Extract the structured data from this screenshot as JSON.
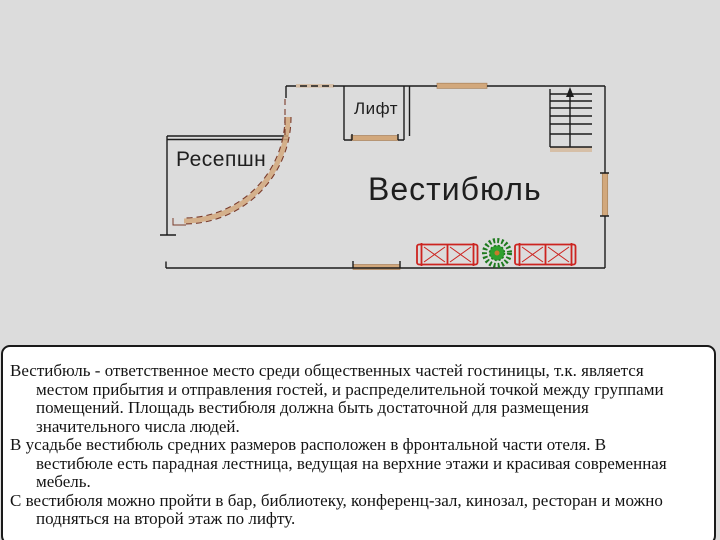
{
  "theme": {
    "slide_bg": "#dcdcdc",
    "wall": "#1c1c1c",
    "door": "#d2a87c",
    "door_edge": "#a8825c",
    "desk_edge": "#7a3b2a",
    "sofa": "#cc2420",
    "plant": "#2fa02f",
    "plant_dark": "#1e7a1e",
    "plant_center": "#c87a2a",
    "panel_bg": "#ffffff",
    "panel_border": "#1a1a1a",
    "text": "#141414"
  },
  "plan": {
    "labels": {
      "elevator": "Лифт",
      "reception": "Ресепшн",
      "lobby": "Вестибюль"
    },
    "furniture": [
      "sofa",
      "plant",
      "sofa",
      "reception-desk",
      "stairs"
    ]
  },
  "notes": {
    "paragraphs": [
      {
        "lines": [
          "Вестибюль - ответственное место среди общественных частей гостиницы, т.к. является",
          "местом прибытия и отправления гостей, и распределительной точкой между группами",
          "помещений. Площадь вестибюля должна быть достаточной для размещения",
          "значительного числа людей."
        ]
      },
      {
        "lines": [
          "В усадьбе вестибюль средних размеров расположен в фронтальной части отеля. В",
          "вестибюле есть парадная лестница, ведущая на верхние этажи и красивая современная",
          "мебель."
        ]
      },
      {
        "lines": [
          "С вестибюля можно пройти в бар, библиотеку, конференц-зал, кинозал, ресторан и можно",
          "подняться на второй этаж по лифту."
        ]
      }
    ]
  }
}
